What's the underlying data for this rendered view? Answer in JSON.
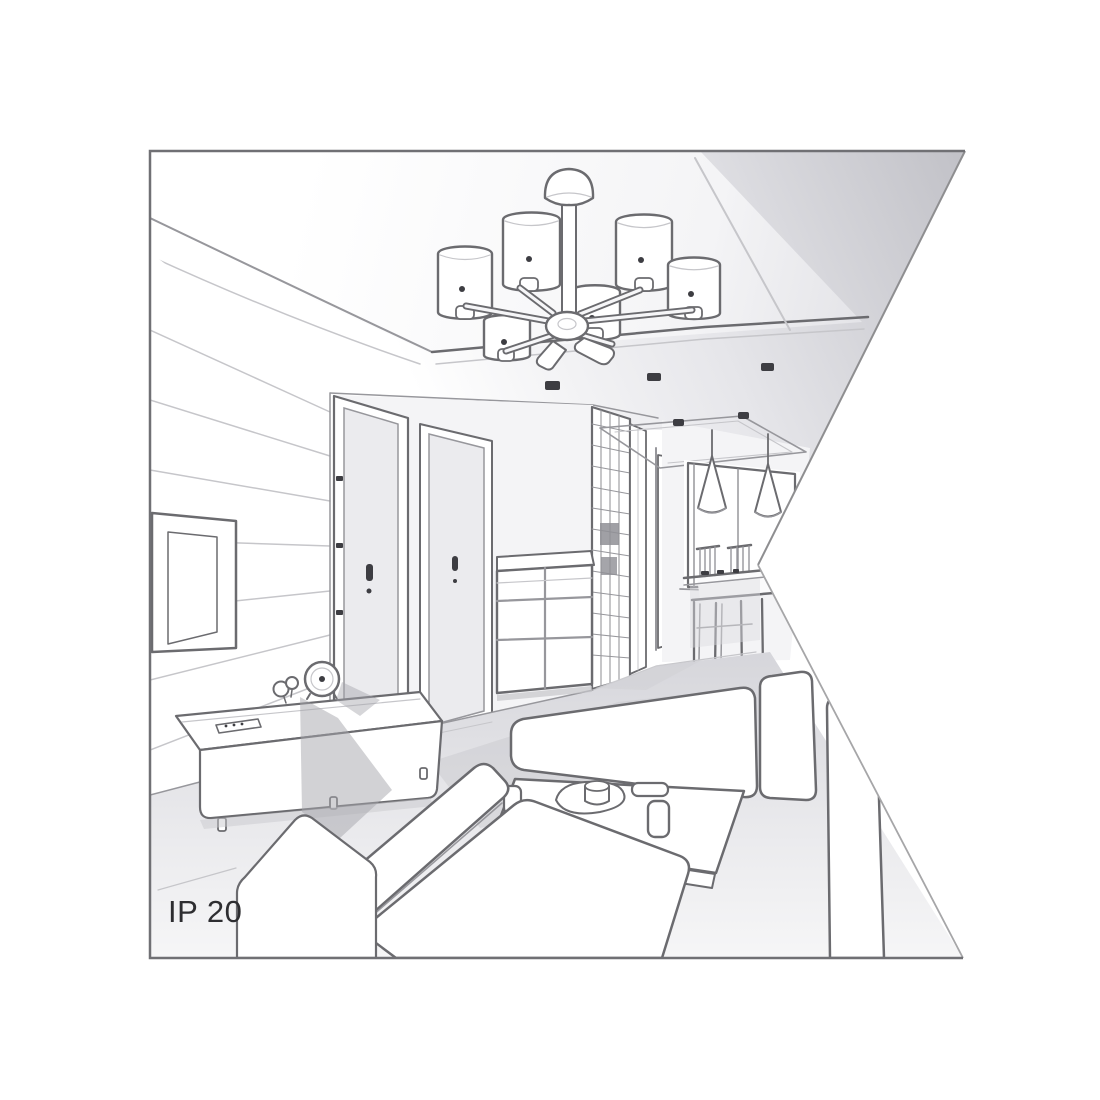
{
  "figure": {
    "label": "IP 20"
  },
  "colors": {
    "line": "#6b6b6f",
    "mid": "#97979c",
    "faint": "#c6c6ca",
    "paper": "#ffffff",
    "wall": "#f4f4f6",
    "door": "#ebebee",
    "spot": "#3d3d42",
    "text": "#2e2e31",
    "border": "#707074",
    "ceiling_dark": "#c2c2c8",
    "floor_dark": "#d6d6db"
  }
}
